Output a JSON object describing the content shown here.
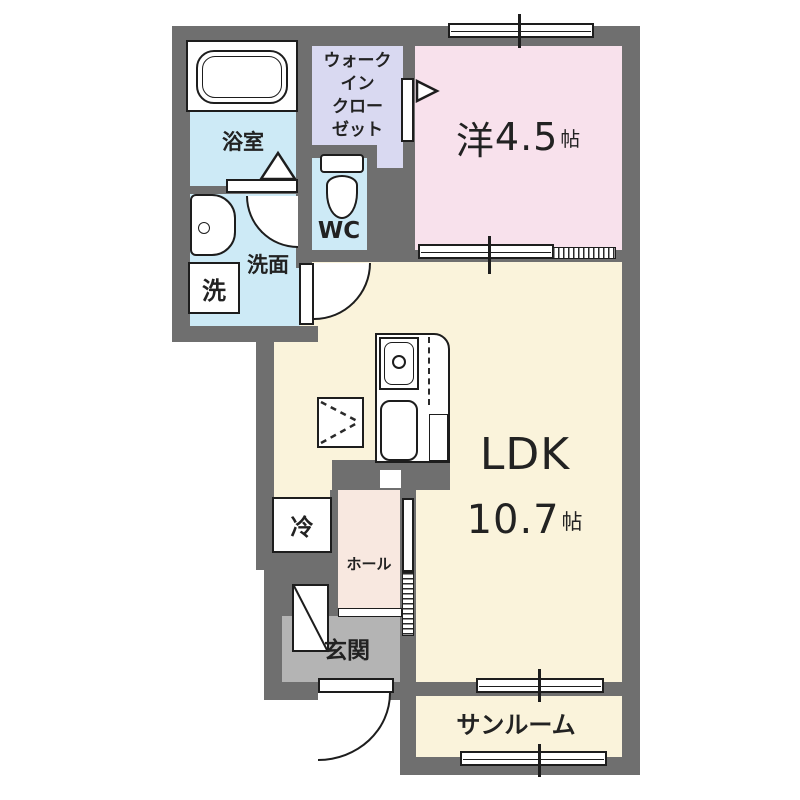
{
  "floorplan": {
    "colors": {
      "wall": "#6f6f6f",
      "wet_area": "#cdeaf6",
      "closet": "#d9d9f1",
      "bedroom": "#f8e1ec",
      "living": "#faf3db",
      "hall": "#f8e8e0",
      "entrance": "#b4b4b4"
    },
    "rooms": {
      "bathroom": {
        "label": "浴室"
      },
      "walk_in_closet": {
        "lines": [
          "ウォーク",
          "イン",
          "クロー",
          "ゼット"
        ]
      },
      "wc": {
        "label": "WC"
      },
      "western_room": {
        "prefix": "洋",
        "size": "4.5",
        "unit": "帖"
      },
      "washroom": {
        "label": "洗面"
      },
      "washing_machine": {
        "label": "洗"
      },
      "ldk": {
        "label": "LDK",
        "size": "10.7",
        "unit": "帖"
      },
      "refrigerator": {
        "label": "冷"
      },
      "hall": {
        "label": "ホール"
      },
      "entrance": {
        "label": "玄関"
      },
      "sunroom": {
        "label": "サンルーム"
      }
    }
  }
}
